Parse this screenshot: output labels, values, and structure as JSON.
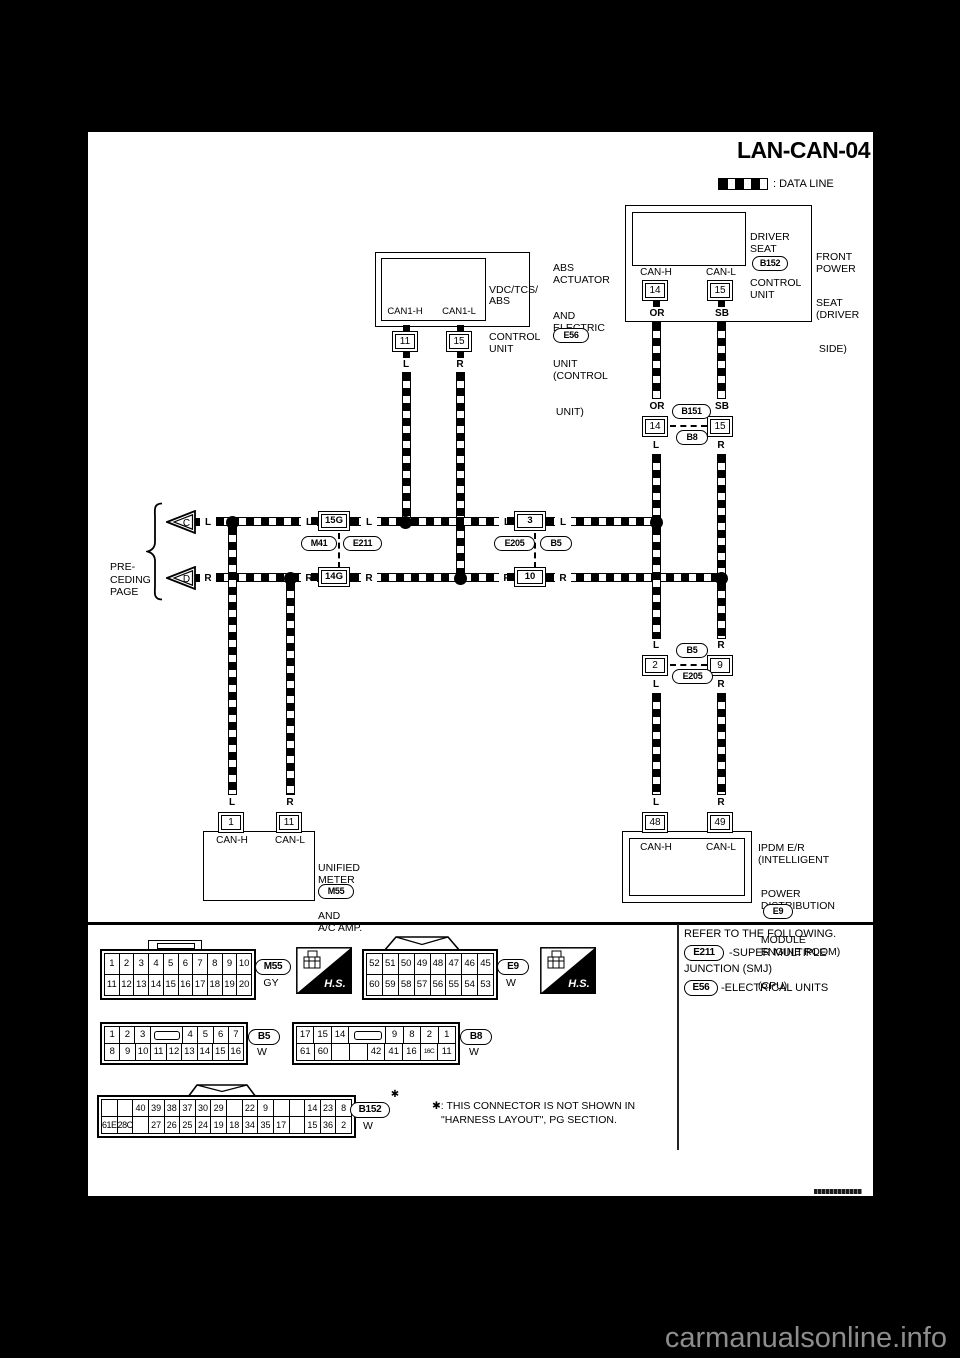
{
  "page": {
    "title": "LAN-CAN-04",
    "watermark": "carmanualsonline.info"
  },
  "legend": {
    "label": ": DATA LINE"
  },
  "labels": {
    "L": "L",
    "R": "R",
    "OR": "OR",
    "SB": "SB",
    "CAN_H": "CAN-H",
    "CAN_L": "CAN-L",
    "CAN1_H": "CAN1-H",
    "CAN1_L": "CAN1-L"
  },
  "preceding": {
    "lines": [
      "PRE-",
      "CEDING",
      "PAGE"
    ],
    "triangles": [
      "C",
      "D"
    ]
  },
  "abs": {
    "name_lines": [
      "VDC/TCS/",
      "ABS",
      "CONTROL",
      "UNIT"
    ],
    "pins": [
      "11",
      "15"
    ],
    "side_lines": [
      "ABS",
      "ACTUATOR",
      "AND",
      "ELECTRIC",
      "UNIT",
      "(CONTROL",
      " UNIT)"
    ],
    "connector": "E56"
  },
  "seat": {
    "name_lines": [
      "DRIVER",
      "SEAT",
      "CONTROL",
      "UNIT"
    ],
    "connector": "B152",
    "pins": [
      "14",
      "15"
    ],
    "side_lines": [
      "FRONT",
      "POWER",
      "SEAT",
      "(DRIVER",
      " SIDE)"
    ]
  },
  "j1": {
    "pins": [
      "14",
      "15"
    ],
    "oval_top": "B151",
    "oval_bottom": "B8"
  },
  "smj": {
    "top": "15G",
    "bottom": "14G",
    "oval_left": "M41",
    "oval_right": "E211"
  },
  "mid": {
    "top": "3",
    "bottom": "10",
    "oval_left": "E205",
    "oval_right": "B5"
  },
  "j2": {
    "pins": [
      "2",
      "9"
    ],
    "oval_top": "B5",
    "oval_bottom": "E205"
  },
  "meter": {
    "pins": [
      "1",
      "11"
    ],
    "name_lines": [
      "UNIFIED",
      "METER",
      "AND",
      "A/C AMP."
    ],
    "connector": "M55"
  },
  "ipdm": {
    "pins": [
      "48",
      "49"
    ],
    "name_lines": [
      "IPDM E/R",
      "(INTELLIGENT",
      " POWER",
      " DISTRIBUTION",
      " MODULE",
      " ENGINE ROOM)",
      "(CPU)"
    ],
    "connector": "E9"
  },
  "footer": {
    "hs": "H.S.",
    "m55": {
      "id": "M55",
      "color": "GY",
      "rows": [
        [
          "1",
          "2",
          "3",
          "4",
          "5",
          "6",
          "7",
          "8",
          "9",
          "10"
        ],
        [
          "11",
          "12",
          "13",
          "14",
          "15",
          "16",
          "17",
          "18",
          "19",
          "20"
        ]
      ]
    },
    "e9": {
      "id": "E9",
      "color": "W",
      "rows": [
        [
          "52",
          "51",
          "50",
          "49",
          "48",
          "47",
          "46",
          "45"
        ],
        [
          "60",
          "59",
          "58",
          "57",
          "56",
          "55",
          "54",
          "53"
        ]
      ]
    },
    "b5": {
      "id": "B5",
      "color": "W",
      "rows": [
        [
          "1",
          "2",
          "3",
          "TAB",
          "4",
          "5",
          "6",
          "7"
        ],
        [
          "8",
          "9",
          "10",
          "11",
          "12",
          "13",
          "14",
          "15",
          "16"
        ]
      ]
    },
    "b8": {
      "id": "B8",
      "color": "W",
      "rows": [
        [
          "17",
          "15",
          "14",
          "TAB",
          "9",
          "8",
          "2",
          "1"
        ],
        [
          "61",
          "60",
          "",
          "",
          "42",
          "41",
          "16",
          "16C",
          "11"
        ]
      ]
    },
    "b152": {
      "id": "B152",
      "color": "W",
      "star": "✱",
      "rows": [
        [
          "",
          "",
          "40",
          "39",
          "38",
          "37",
          "30",
          "29",
          "",
          "22",
          "9",
          "",
          "",
          "14",
          "23",
          "8"
        ],
        [
          "61E",
          "28C",
          "",
          "27",
          "26",
          "25",
          "24",
          "19",
          "18",
          "34",
          "35",
          "17",
          "",
          "15",
          "36",
          "2"
        ]
      ]
    },
    "note_lines": [
      "✱: THIS CONNECTOR IS NOT SHOWN IN",
      "\"HARNESS LAYOUT\", PG SECTION."
    ],
    "refer": {
      "title": "REFER TO THE FOLLOWING.",
      "item1_code": "E211",
      "item1_text": "-SUPER MULTIPLE",
      "item1_text2": "JUNCTION (SMJ)",
      "item2_code": "E56",
      "item2_text": "-ELECTRICAL UNITS"
    }
  }
}
